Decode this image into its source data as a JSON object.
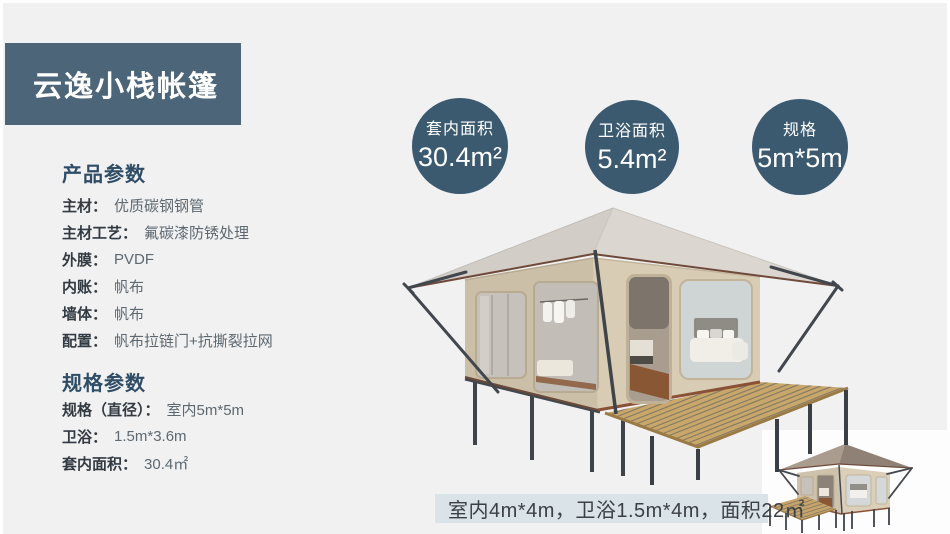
{
  "title": "云逸小栈帐篷",
  "stats": [
    {
      "label": "套内面积",
      "value": "30.4m²"
    },
    {
      "label": "卫浴面积",
      "value": "5.4m²"
    },
    {
      "label": "规格",
      "value": "5m*5m"
    }
  ],
  "sections": [
    {
      "heading": "产品参数",
      "rows": [
        {
          "label": "主材：",
          "value": "优质碳钢钢管"
        },
        {
          "label": "主材工艺：",
          "value": "氟碳漆防锈处理"
        },
        {
          "label": "外膜：",
          "value": "PVDF"
        },
        {
          "label": "内账：",
          "value": "帆布"
        },
        {
          "label": "墙体：",
          "value": "帆布"
        },
        {
          "label": "配置：",
          "value": "帆布拉链门+抗撕裂拉网"
        }
      ]
    },
    {
      "heading": "规格参数",
      "rows": [
        {
          "label": "规格（直径）：",
          "value": "室内5m*5m"
        },
        {
          "label": "卫浴：",
          "value": "1.5m*3.6m"
        },
        {
          "label": "套内面积：",
          "value": "30.4㎡"
        }
      ]
    }
  ],
  "caption": {
    "text": "室内4m*4m，卫浴1.5m*4m，面积22㎡"
  },
  "colors": {
    "slide_bg": "#f1f1f2",
    "title_bg": "#4d6579",
    "title_text": "#ffffff",
    "heading_text": "#2f4d66",
    "label_text": "#323a42",
    "value_text": "#5d6870",
    "circle_bg": "#3b5a70",
    "circle_text": "#ffffff",
    "caption_bg": "#d9e3e8",
    "caption_text": "#3b4045"
  }
}
